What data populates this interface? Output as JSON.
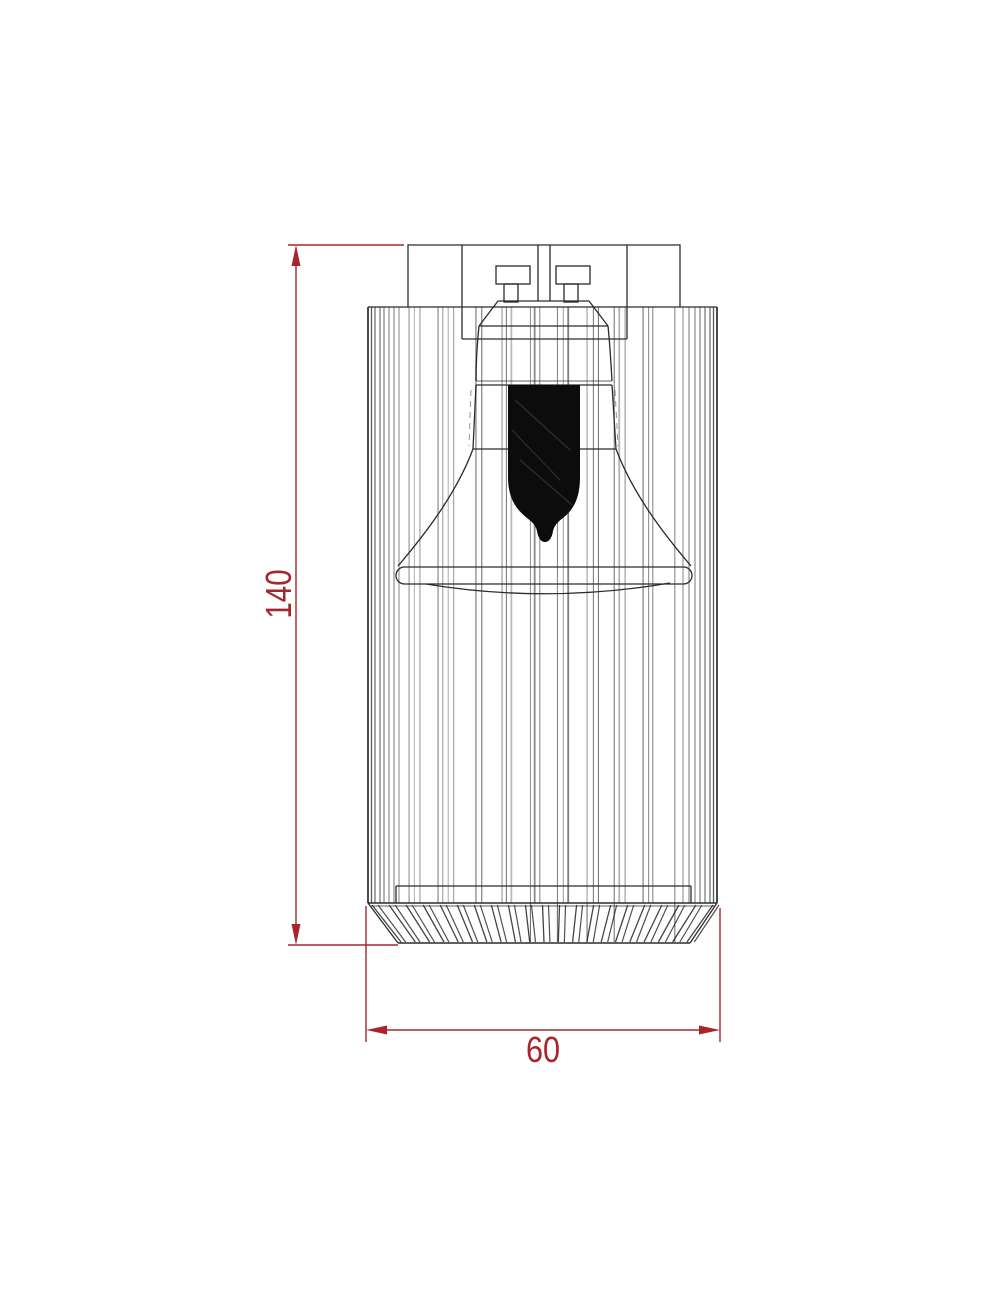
{
  "dimensions": {
    "height": {
      "label": "140"
    },
    "width": {
      "label": "60"
    }
  },
  "colors": {
    "background": "#ffffff",
    "line": "#2b2b2b",
    "dimension_red": "#a8262b",
    "lamp_fill": "#0c0c0c"
  }
}
